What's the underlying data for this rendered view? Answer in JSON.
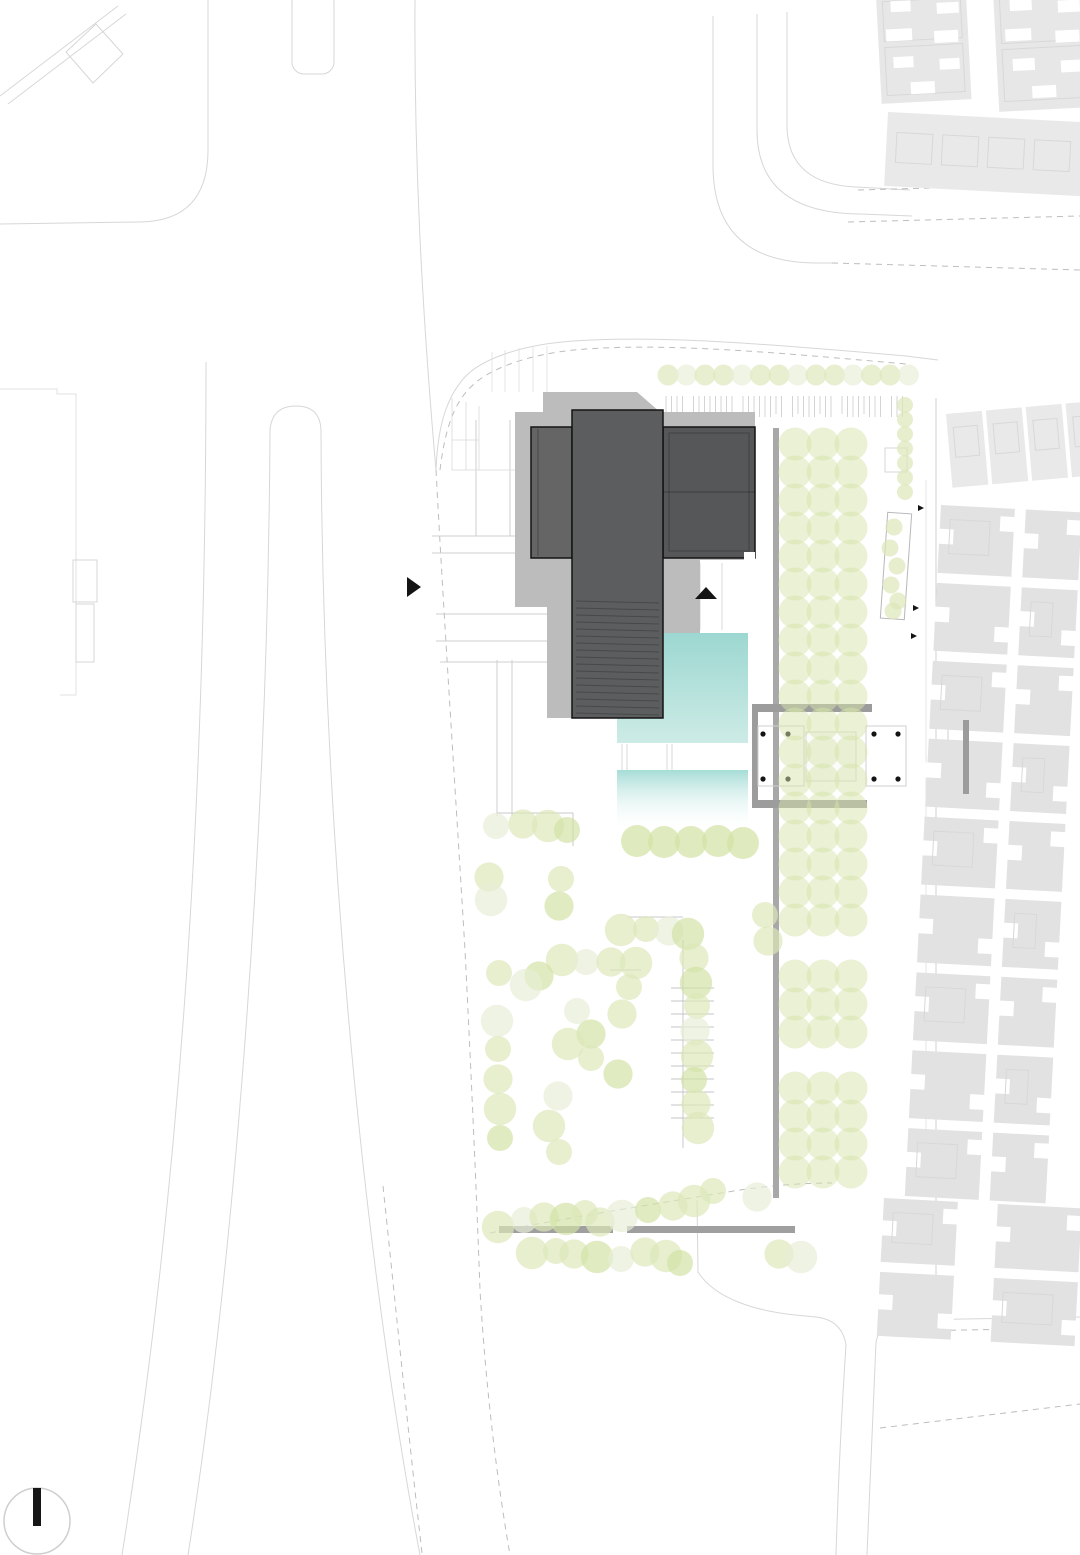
{
  "meta": {
    "kind": "architectural-site-plan",
    "canvas": {
      "width": 1080,
      "height": 1555
    }
  },
  "colors": {
    "background": "#ffffff",
    "road_line": "#d7d7d7",
    "dash_line": "#bdbdbd",
    "hairline": "#dcdcdc",
    "walk_line": "#cfcfcf",
    "block_gray": "#e2e2e2",
    "block_gray_light": "#e9e9e9",
    "block_inner": "#d8d8d8",
    "shadow": "#bcbcbc",
    "building_dark": "#5c5d5e",
    "building_left": "#656565",
    "building_right": "#565758",
    "building_outline": "#141414",
    "hatch_dark": "rgba(0,0,0,0.22)",
    "pool_top": "#9dd7d1",
    "pool_bottom": "#cdebe6",
    "pool2_top": "#a6dcd6",
    "pavilion_gray": "#9c9c9c",
    "avenue_bar": "#a8a8a8",
    "edge_bar": "#9f9f9f",
    "tree_fill": "#dbe7b8",
    "tree_light": "#e7eed6",
    "tree_dark": "#d2e2a4",
    "bosque_fill": "#d6e3a9",
    "column_dot": "#141414",
    "north_bar": "#161616",
    "north_circle": "#cfcfcf",
    "fence_stroke": "#9a9a9a",
    "parking_line": "#c4c4c4"
  },
  "plan": {
    "roads": [
      {
        "d": "M0,96 L118,6"
      },
      {
        "d": "M8,104 L126,14"
      },
      {
        "d": "M66,52 L96,24 L123,54 L93,83 Z"
      },
      {
        "d": "M208,0 L208,150 Q208,221 140,222 L0,224"
      },
      {
        "d": "M415,0 C414,150 421,300 436,470"
      },
      {
        "d": "M436,470 C444,620 456,800 465,950 C471,1070 476,1180 480,1290 C486,1390 497,1480 510,1555",
        "dash": true
      },
      {
        "d": "M383,1186 C396,1310 409,1440 422,1553",
        "dash": true
      },
      {
        "d": "M206,362 C206,750 186,1150 122,1555"
      },
      {
        "d": "M270,430 C268,820 236,1250 188,1555"
      },
      {
        "d": "M270,430 Q272,406 296,406 Q320,406 321,430"
      },
      {
        "d": "M321,430 C322,820 362,1250 420,1555"
      },
      {
        "d": "M0,389 L57,389 L57,394 L76,394 L76,695 L60,695",
        "w": 0.8,
        "c": "#d9d9d9"
      },
      {
        "d": "M713,16 L713,165 Q713,262 815,263 L832,263"
      },
      {
        "d": "M832,263 L1080,270",
        "dash": true
      },
      {
        "d": "M757,14 L757,130 Q757,213 860,214 L912,216"
      },
      {
        "d": "M787,12 L787,128 Q789,184 856,187 L910,190"
      },
      {
        "d": "M858,190 L1080,184",
        "dash": true
      },
      {
        "d": "M848,222 L1080,216",
        "dash": true
      },
      {
        "d": "M436,470 C438,418 450,394 464,378 C482,358 522,346 562,342 C650,334 768,344 906,356 L938,360"
      },
      {
        "d": "M440,470 C446,420 458,398 474,384 C494,366 534,354 574,350 C660,342 770,352 906,364",
        "dash": true
      },
      {
        "d": "M936,398 L936,1322",
        "c": "#d2d2d2"
      },
      {
        "d": "M926,480 L926,1190",
        "w": 0.8,
        "c": "#e0e0e0"
      },
      {
        "d": "M846,1345 C841,1420 838,1490 836,1555"
      },
      {
        "d": "M876,1342 C872,1430 869,1500 867,1555"
      },
      {
        "d": "M876,1342 Q880,1322 906,1320 L1080,1317"
      },
      {
        "d": "M906,1331 L1080,1328",
        "dash": true
      },
      {
        "d": "M846,1345 Q842,1320 816,1317 L795,1315"
      },
      {
        "d": "M795,1315 C758,1311 716,1300 698,1272 L697,1200"
      },
      {
        "d": "M880,1428 L1080,1404",
        "dash": true
      },
      {
        "d": "M490,1233 C560,1219 660,1203 740,1190 C775,1185 805,1183 832,1183",
        "dash": true
      },
      {
        "d": "M497,813 L573,813",
        "c": "#c9c9c9"
      },
      {
        "d": "M573,813 L573,846",
        "c": "#c9c9c9"
      },
      {
        "d": "M628,917 L683,917",
        "c": "#c9c9c9"
      },
      {
        "d": "M683,940 L683,1148",
        "c": "#c9c9c9"
      },
      {
        "d": "M610,970 L641,970",
        "c": "#c9c9c9"
      },
      {
        "d": "M432,536 L572,536",
        "c": "#cfcfcf"
      },
      {
        "d": "M432,553 L572,553",
        "c": "#cfcfcf"
      },
      {
        "d": "M436,614 L575,614",
        "c": "#cfcfcf"
      },
      {
        "d": "M436,641 L575,641",
        "c": "#cfcfcf"
      },
      {
        "d": "M476,420 L476,536",
        "c": "#cfcfcf"
      },
      {
        "d": "M510,420 L510,536",
        "c": "#cfcfcf"
      },
      {
        "d": "M497,660 L497,816",
        "c": "#cfcfcf"
      },
      {
        "d": "M512,660 L512,816",
        "c": "#cfcfcf"
      },
      {
        "d": "M440,662 L573,662",
        "c": "#cfcfcf"
      },
      {
        "d": "M678,563 L678,630",
        "c": "#d9d9d9"
      },
      {
        "d": "M700,563 L700,630",
        "c": "#d9d9d9"
      },
      {
        "d": "M722,563 L722,630",
        "c": "#d9d9d9"
      },
      {
        "d": "M492,352 L492,392",
        "w": 0.7,
        "c": "#dcdcdc"
      },
      {
        "d": "M505,350 L505,392",
        "w": 0.7,
        "c": "#dcdcdc"
      },
      {
        "d": "M519,348 L519,392",
        "w": 0.7,
        "c": "#dcdcdc"
      },
      {
        "d": "M533,347 L533,392",
        "w": 0.7,
        "c": "#dcdcdc"
      },
      {
        "d": "M547,346 L547,392",
        "w": 0.7,
        "c": "#dcdcdc"
      },
      {
        "d": "M452,398 L452,470",
        "w": 0.8,
        "c": "#d9d9d9"
      },
      {
        "d": "M466,402 L466,470",
        "w": 0.8,
        "c": "#d9d9d9"
      },
      {
        "d": "M479,406 L479,470",
        "w": 0.8,
        "c": "#d9d9d9"
      },
      {
        "d": "M452,470 L530,470",
        "w": 0.8,
        "c": "#d9d9d9"
      },
      {
        "d": "M452,440 L479,440",
        "w": 0.8,
        "c": "#d9d9d9"
      },
      {
        "d": "M622,744 L622,770",
        "w": 0.8,
        "c": "#d0d0d0"
      },
      {
        "d": "M627,744 L627,770",
        "w": 0.8,
        "c": "#d0d0d0"
      },
      {
        "d": "M667,744 L667,770",
        "w": 0.8,
        "c": "#d0d0d0"
      },
      {
        "d": "M672,744 L672,770",
        "w": 0.8,
        "c": "#d0d0d0"
      },
      {
        "d": "M948,722 L969,722",
        "c": "#cfcfcf"
      },
      {
        "d": "M948,722 L948,792",
        "c": "#cfcfcf"
      },
      {
        "d": "M948,792 L969,792",
        "c": "#cfcfcf"
      }
    ],
    "thin_rects": [
      {
        "x": 292,
        "y": -10,
        "w": 42,
        "h": 84,
        "rx": 12
      },
      {
        "x": 73,
        "y": 560,
        "w": 24,
        "h": 42
      },
      {
        "x": 76,
        "y": 604,
        "w": 18,
        "h": 58
      },
      {
        "x": 885,
        "y": 448,
        "w": 22,
        "h": 24
      },
      {
        "x": 884,
        "y": 513,
        "w": 24,
        "h": 106,
        "rot": [
          4,
          896,
          566
        ],
        "c": "#b8b8b8"
      }
    ],
    "residential_clusters": [
      {
        "name": "top-right-cluster-a",
        "tx": 876,
        "ty": -4,
        "rot": -3,
        "base": [
          0,
          0,
          90,
          108
        ],
        "fill": "#e7e7e7",
        "notches": [
          [
            14,
            6,
            20,
            11
          ],
          [
            60,
            10,
            22,
            11
          ],
          [
            8,
            34,
            26,
            12
          ],
          [
            56,
            38,
            24,
            12
          ],
          [
            14,
            62,
            20,
            11
          ],
          [
            60,
            66,
            20,
            11
          ],
          [
            30,
            88,
            24,
            12
          ]
        ],
        "inner": [
          [
            6,
            6,
            78,
            40
          ],
          [
            6,
            52,
            78,
            48
          ]
        ]
      },
      {
        "name": "top-right-cluster-b",
        "tx": 993,
        "ty": -8,
        "rot": -3,
        "base": [
          0,
          0,
          100,
          120
        ],
        "fill": "#e7e7e7",
        "notches": [
          [
            16,
            8,
            22,
            12
          ],
          [
            64,
            12,
            22,
            12
          ],
          [
            10,
            38,
            26,
            12
          ],
          [
            60,
            42,
            24,
            12
          ],
          [
            16,
            68,
            22,
            12
          ],
          [
            64,
            72,
            22,
            12
          ],
          [
            34,
            96,
            24,
            12
          ]
        ],
        "inner": [
          [
            6,
            8,
            88,
            44
          ],
          [
            6,
            58,
            88,
            52
          ]
        ]
      },
      {
        "name": "top-right-slab",
        "tx": 888,
        "ty": 112,
        "rot": 3,
        "base": [
          0,
          0,
          196,
          74
        ],
        "fill": "#e9e9e9",
        "notches": [],
        "inner": [
          [
            10,
            20,
            36,
            30
          ],
          [
            56,
            20,
            36,
            30
          ],
          [
            102,
            20,
            36,
            30
          ],
          [
            148,
            20,
            36,
            30
          ]
        ]
      }
    ],
    "courtyard_band": {
      "tx": 946,
      "ty": 414,
      "rot": -5,
      "squares": [
        {
          "x": 0,
          "y": 0,
          "w": 36,
          "h": 74,
          "inner": [
            6,
            14,
            24,
            30
          ]
        },
        {
          "x": 40,
          "y": 0,
          "w": 36,
          "h": 74,
          "inner": [
            6,
            14,
            24,
            30
          ]
        },
        {
          "x": 80,
          "y": 0,
          "w": 36,
          "h": 74,
          "inner": [
            6,
            14,
            24,
            30
          ]
        },
        {
          "x": 120,
          "y": 0,
          "w": 36,
          "h": 74,
          "inner": [
            6,
            14,
            24,
            30
          ]
        }
      ]
    },
    "residential_fields": [
      {
        "name": "right-field-upper",
        "rot": [
          3,
          941,
          505
        ],
        "cols": [
          {
            "x": 941,
            "w": 74
          },
          {
            "x": 1026,
            "w": 56
          }
        ],
        "y0": 505,
        "rows": 9,
        "pitch": 78,
        "h": 68
      },
      {
        "name": "right-field-lower",
        "rot": [
          3,
          884,
          1198
        ],
        "cols": [
          {
            "x": 884,
            "w": 74
          },
          {
            "x": 998,
            "w": 84
          }
        ],
        "y0": 1198,
        "rows": 2,
        "pitch": 74,
        "h": 64
      }
    ],
    "bars": [
      {
        "x": 773,
        "y": 428,
        "w": 6,
        "h": 770,
        "c": "avenue_bar",
        "name": "avenue-edge-bar"
      },
      {
        "x": 499,
        "y": 1226,
        "w": 114,
        "h": 7,
        "c": "edge_bar",
        "name": "site-south-bar-west"
      },
      {
        "x": 627,
        "y": 1226,
        "w": 168,
        "h": 7,
        "c": "edge_bar",
        "name": "site-south-bar-east"
      },
      {
        "x": 963,
        "y": 720,
        "w": 6,
        "h": 74,
        "c": "pavilion_gray",
        "name": "gate-axis-bar"
      }
    ],
    "pools": {
      "upper_path": "M663,633 L748,633 L748,743 L617,743 L617,718 L663,718 Z",
      "lower": {
        "x": 617,
        "y": 770,
        "w": 131,
        "h": 62
      }
    },
    "shadow_path": "M543,392 L637,392 L660,412 L755,412 L755,560 L700,560 L700,633 L663,633 L663,718 L547,718 L547,607 L515,607 L515,412 L543,412 Z",
    "building": {
      "volumes": [
        {
          "x": 531,
          "y": 427,
          "w": 41,
          "h": 131,
          "fill": "building_left",
          "name": "west-wing"
        },
        {
          "x": 663,
          "y": 427,
          "w": 92,
          "h": 131,
          "fill": "building_right",
          "name": "east-wing"
        },
        {
          "x": 572,
          "y": 410,
          "w": 91,
          "h": 308,
          "fill": "building_dark",
          "name": "central-tower"
        }
      ],
      "inner_lines": [
        [
          538,
          429,
          538,
          556
        ],
        [
          663,
          492,
          755,
          492
        ]
      ],
      "inner_rect": [
        669,
        433,
        80,
        118
      ],
      "notch_white": [
        744,
        552,
        11,
        8
      ],
      "hatch": {
        "x1": 576,
        "x2": 659,
        "y0": 601,
        "step": 7,
        "n": 17
      }
    },
    "pavilion": {
      "bars": [
        [
          752,
          704,
          120,
          8
        ],
        [
          752,
          800,
          115,
          8
        ],
        [
          752,
          704,
          6,
          104
        ]
      ],
      "outlines": [
        [
          758,
          726,
          46,
          60
        ],
        [
          866,
          726,
          40,
          60
        ]
      ],
      "platform": [
        806,
        732,
        50,
        49
      ],
      "dots": [
        [
          763,
          734
        ],
        [
          788,
          734
        ],
        [
          763,
          779
        ],
        [
          788,
          779
        ],
        [
          874,
          734
        ],
        [
          898,
          734
        ],
        [
          874,
          779
        ],
        [
          898,
          779
        ]
      ]
    },
    "fence": {
      "x0": 666,
      "dx": 5.5,
      "n": 44,
      "y1": 396,
      "y2": 417
    },
    "parking": {
      "x1": 671,
      "x2": 714,
      "y0": 988,
      "step": 13,
      "n": 11
    },
    "bosque": {
      "x0": 795,
      "dx": 28,
      "cols": 3,
      "y0": 444,
      "dy": 28,
      "rows": 27,
      "r": 16.5,
      "skip_rows": [
        18,
        22
      ]
    },
    "tree_row_top": {
      "x0": 668,
      "step": 18.5,
      "n": 14,
      "y": 375,
      "r": 10.5
    },
    "tree_column_right": {
      "x": 905,
      "y0": 405,
      "step": 14.5,
      "n": 7,
      "r": 8
    },
    "strip_trees": [
      [
        894,
        527
      ],
      [
        890,
        548
      ],
      [
        897,
        566
      ],
      [
        891,
        585
      ],
      [
        898,
        601
      ],
      [
        893,
        611
      ]
    ],
    "poolside_row": [
      [
        637,
        841
      ],
      [
        664,
        842
      ],
      [
        691,
        842
      ],
      [
        718,
        841
      ],
      [
        743,
        843
      ]
    ],
    "scattered_trees": [
      [
        496,
        826
      ],
      [
        523,
        824
      ],
      [
        548,
        826
      ],
      [
        567,
        830
      ],
      [
        489,
        877
      ],
      [
        491,
        900
      ],
      [
        561,
        879
      ],
      [
        559,
        906
      ],
      [
        621,
        930
      ],
      [
        646,
        929
      ],
      [
        669,
        931
      ],
      [
        688,
        934
      ],
      [
        765,
        915
      ],
      [
        768,
        941
      ],
      [
        562,
        960
      ],
      [
        586,
        962
      ],
      [
        611,
        962
      ],
      [
        636,
        963
      ],
      [
        499,
        973
      ],
      [
        539,
        976
      ],
      [
        526,
        985
      ],
      [
        629,
        987
      ],
      [
        694,
        958
      ],
      [
        696,
        983
      ],
      [
        697,
        1006
      ],
      [
        695,
        1031
      ],
      [
        697,
        1056
      ],
      [
        694,
        1080
      ],
      [
        696,
        1104
      ],
      [
        698,
        1128
      ],
      [
        577,
        1011
      ],
      [
        591,
        1034
      ],
      [
        568,
        1044
      ],
      [
        591,
        1058
      ],
      [
        622,
        1014
      ],
      [
        497,
        1021
      ],
      [
        498,
        1049
      ],
      [
        498,
        1079
      ],
      [
        500,
        1109
      ],
      [
        500,
        1138
      ],
      [
        558,
        1096
      ],
      [
        549,
        1126
      ],
      [
        559,
        1152
      ],
      [
        618,
        1074
      ],
      [
        498,
        1227
      ],
      [
        524,
        1220
      ],
      [
        544,
        1217
      ],
      [
        566,
        1219
      ],
      [
        585,
        1213
      ],
      [
        600,
        1222
      ],
      [
        622,
        1216
      ],
      [
        648,
        1210
      ],
      [
        673,
        1206
      ],
      [
        694,
        1201
      ],
      [
        713,
        1191
      ],
      [
        757,
        1197
      ],
      [
        532,
        1253
      ],
      [
        556,
        1251
      ],
      [
        574,
        1254
      ],
      [
        597,
        1257
      ],
      [
        621,
        1259
      ],
      [
        645,
        1252
      ],
      [
        666,
        1256
      ],
      [
        680,
        1263
      ],
      [
        779,
        1254
      ],
      [
        801,
        1257
      ]
    ],
    "arrows": {
      "entry_west": [
        [
          407,
          577
        ],
        [
          407,
          597
        ],
        [
          421,
          587
        ]
      ],
      "entry_south": [
        [
          695,
          599
        ],
        [
          717,
          599
        ],
        [
          706,
          587
        ]
      ],
      "small": [
        [
          [
            918,
            505
          ],
          [
            918,
            511
          ],
          [
            924,
            508
          ]
        ],
        [
          [
            913,
            605
          ],
          [
            913,
            611
          ],
          [
            919,
            608
          ]
        ],
        [
          [
            911,
            633
          ],
          [
            911,
            639
          ],
          [
            917,
            636
          ]
        ]
      ]
    },
    "north_arrow": {
      "cx": 37,
      "cy": 1521,
      "r": 33,
      "bar": [
        33,
        1488,
        8,
        38
      ]
    }
  }
}
